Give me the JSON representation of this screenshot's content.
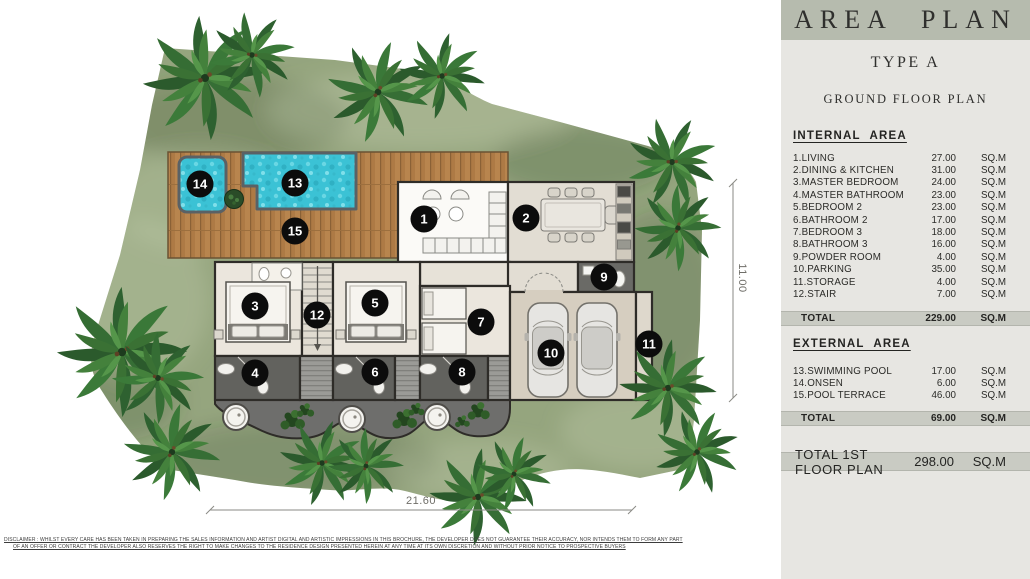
{
  "panel": {
    "title": "AREA PLAN",
    "subtitle": "TYPE A",
    "plan_name": "GROUND FLOOR PLAN",
    "internal": {
      "heading": "INTERNAL AREA",
      "items": [
        {
          "label": "1.LIVING",
          "value": "27.00",
          "unit": "SQ.M"
        },
        {
          "label": "2.DINING & KITCHEN",
          "value": "31.00",
          "unit": "SQ.M"
        },
        {
          "label": "3.MASTER BEDROOM",
          "value": "24.00",
          "unit": "SQ.M"
        },
        {
          "label": "4.MASTER BATHROOM",
          "value": "23.00",
          "unit": "SQ.M"
        },
        {
          "label": "5.BEDROOM 2",
          "value": "23.00",
          "unit": "SQ.M"
        },
        {
          "label": "6.BATHROOM 2",
          "value": "17.00",
          "unit": "SQ.M"
        },
        {
          "label": "7.BEDROOM 3",
          "value": "18.00",
          "unit": "SQ.M"
        },
        {
          "label": "8.BATHROOM 3",
          "value": "16.00",
          "unit": "SQ.M"
        },
        {
          "label": "9.POWDER ROOM",
          "value": "4.00",
          "unit": "SQ.M"
        },
        {
          "label": "10.PARKING",
          "value": "35.00",
          "unit": "SQ.M"
        },
        {
          "label": "11.STORAGE",
          "value": "4.00",
          "unit": "SQ.M"
        },
        {
          "label": "12.STAIR",
          "value": "7.00",
          "unit": "SQ.M"
        }
      ],
      "total": {
        "label": "TOTAL",
        "value": "229.00",
        "unit": "SQ.M"
      }
    },
    "external": {
      "heading": "EXTERNAL AREA",
      "items": [
        {
          "label": "13.SWIMMING POOL",
          "value": "17.00",
          "unit": "SQ.M"
        },
        {
          "label": "14.ONSEN",
          "value": "6.00",
          "unit": "SQ.M"
        },
        {
          "label": "15.POOL TERRACE",
          "value": "46.00",
          "unit": "SQ.M"
        }
      ],
      "total": {
        "label": "TOTAL",
        "value": "69.00",
        "unit": "SQ.M"
      }
    },
    "grand_total": {
      "label": "TOTAL 1ST FLOOR PLAN",
      "value": "298.00",
      "unit": "SQ.M"
    }
  },
  "plan": {
    "dimensions": {
      "width_label": "21.60",
      "height_label": "11.00"
    },
    "markers": [
      {
        "n": "1",
        "x": 424,
        "y": 219
      },
      {
        "n": "2",
        "x": 526,
        "y": 218
      },
      {
        "n": "3",
        "x": 255,
        "y": 306
      },
      {
        "n": "4",
        "x": 255,
        "y": 373
      },
      {
        "n": "5",
        "x": 375,
        "y": 303
      },
      {
        "n": "6",
        "x": 375,
        "y": 372
      },
      {
        "n": "7",
        "x": 481,
        "y": 322
      },
      {
        "n": "8",
        "x": 462,
        "y": 372
      },
      {
        "n": "9",
        "x": 604,
        "y": 277
      },
      {
        "n": "10",
        "x": 551,
        "y": 353
      },
      {
        "n": "11",
        "x": 649,
        "y": 344
      },
      {
        "n": "12",
        "x": 317,
        "y": 315
      },
      {
        "n": "13",
        "x": 295,
        "y": 183
      },
      {
        "n": "14",
        "x": 200,
        "y": 184
      },
      {
        "n": "15",
        "x": 295,
        "y": 231
      }
    ]
  },
  "disclaimer": {
    "line1": "DISCLAIMER : WHILST EVERY CARE HAS BEEN TAKEN IN PREPARING THE SALES INFORMATION AND ARTIST DIGITAL AND ARTISTIC IMPRESSIONS IN THIS BROCHURE, THE DEVELOPER DOES NOT GUARANTEE THEIR ACCURACY, NOR INTENDS THEM TO FORM ANY PART",
    "line2": "OF AN OFFER OR CONTRACT THE DEVELOPER ALSO RESERVES THE RIGHT TO MAKE CHANGES TO THE RESIDENCE DESIGN PRESENTED HEREIN AT ANY TIME AT ITS OWN DISCRETION AND WITHOUT PRIOR NOTICE TO PROSPECTIVE BUYERS"
  },
  "colors": {
    "panel_bg": "#e7e6e2",
    "header_band": "#b6bbae",
    "total_band": "#c9cbc3",
    "lawn": "#95a57e",
    "pool_water": "#3bc2d5",
    "deck_wood": "#b8854e",
    "marker": "#0c0c0c"
  }
}
